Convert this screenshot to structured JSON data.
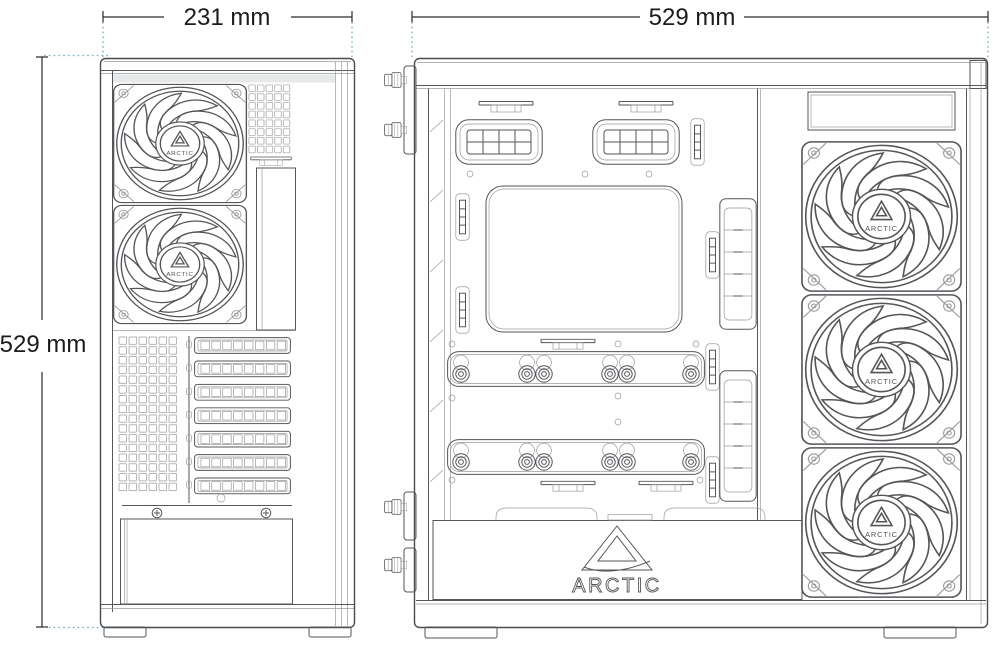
{
  "brand": {
    "name": "ARCTIC"
  },
  "dimension_labels": {
    "rear_width": "231 mm",
    "rear_height": "529 mm",
    "side_width": "529 mm"
  },
  "views": {
    "rear": {
      "fan_count": 2,
      "pci_slot_count": 7
    },
    "side": {
      "fan_count": 3
    }
  },
  "colors": {
    "background": "#ffffff",
    "line": "#55565a",
    "line_light": "#9a9b9e",
    "dimension_line": "#2c2c2e",
    "extension_line": "#6badbd",
    "label_text": "#1b1b1d"
  }
}
